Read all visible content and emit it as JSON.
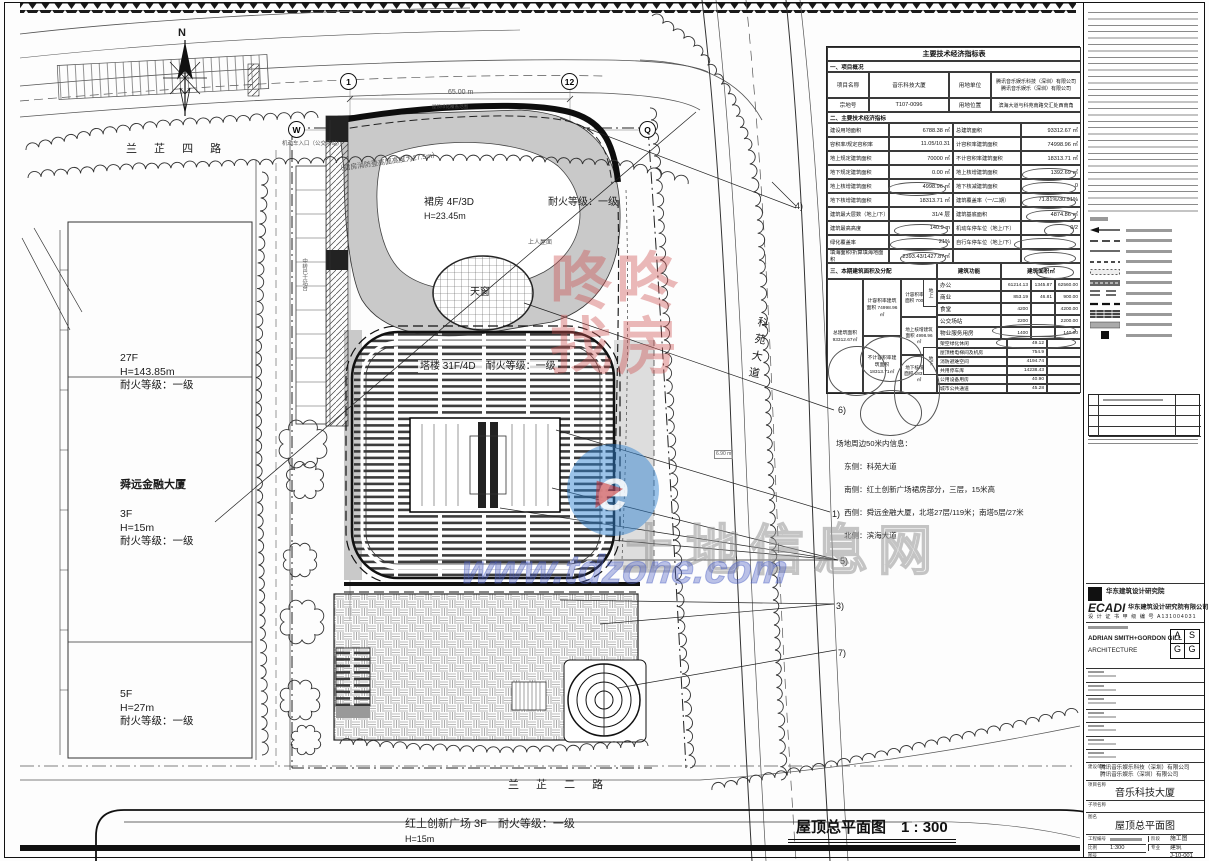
{
  "main_title": {
    "text": "屋顶总平面图",
    "scale": "1 : 300"
  },
  "plan_labels": {
    "north": "N",
    "road_top": "兰 芷 四 路",
    "road_right": "科苑大道",
    "road_bottom": "兰 芷 二 路",
    "b27_1": "27F",
    "b27_2": "H=143.85m",
    "b27_3": "耐火等级：一级",
    "sy_name": "舜远金融大厦",
    "sy_1": "3F",
    "sy_2": "H=15m",
    "sy_3": "耐火等级：一级",
    "b5_1": "5F",
    "b5_2": "H=27m",
    "b5_3": "耐火等级：一级",
    "ht_name": "红土创新广场 3F　耐火等级：一级",
    "ht_h": "H=15m",
    "podium": "裙房 4F/3D",
    "podium_fire": "耐火等级：一级",
    "podium_h": "H=23.45m",
    "tower": "塔楼 31F/4D　耐火等级：一级",
    "skylight": "天窗",
    "roof_access": "上人屋面",
    "entrance": "机动车入口（公交场站）",
    "green_range": "屋顶绿化覆盖范围",
    "fire_height": "（裙房消防登高面高度为27.5m）",
    "bus": "中转巴士站台",
    "dim65": "65.00 m",
    "elev": "6.90 m"
  },
  "bubbles": [
    "1",
    "12",
    "W",
    "Q"
  ],
  "callouts": [
    "1)",
    "2)",
    "3)",
    "4)",
    "5)",
    "6)",
    "7)"
  ],
  "site_note": {
    "title": "场地周边50米内信息：",
    "lines": [
      "东侧：科苑大道",
      "南侧：红土创新广场裙房部分，三层，15米高",
      "西侧：舜远金融大厦，北塔27层/119米；南塔5层/27米",
      "北侧：滨海大道"
    ]
  },
  "econ": {
    "title": "主要技术经济指标表",
    "section1": "一、项目概况",
    "row_name": [
      "项目名称",
      "音乐科技大厦",
      "用地单位"
    ],
    "client_lines": [
      "腾讯音乐娱乐科技（深圳）有限公司",
      "腾讯音乐娱乐（深圳）有限公司"
    ],
    "row_lot": [
      "宗地号",
      "T107-0096",
      "用地位置",
      "滨海大道与科苑南路交汇处西南角"
    ],
    "section2": "二、主要技术经济指标",
    "rows2": [
      [
        "建设用地面积",
        "6788.38 ㎡",
        "总建筑面积",
        "93312.67 ㎡"
      ],
      [
        "容积率/规定容积率",
        "11.05/10.31",
        "计容积率建筑面积",
        "74998.96 ㎡"
      ],
      [
        "地上规定建筑面积",
        "70000 ㎡",
        "不计容积率建筑面积",
        "18313.71 ㎡"
      ],
      [
        "地下规定建筑面积",
        "0.00 ㎡",
        "地上核增建筑面积",
        "1392.69 ㎡"
      ],
      [
        "地上核增建筑面积",
        "4998.96 ㎡",
        "地下核减建筑面积",
        "0"
      ],
      [
        "地下核增建筑面积",
        "18313.71 ㎡",
        "建筑覆盖率（一/二期）",
        "71.81%/30.91%"
      ],
      [
        "建筑最大层数（地上/下）",
        "31/4 层",
        "建筑基底面积",
        "4874.86 ㎡"
      ],
      [
        "建筑最高高度",
        "140.9 m",
        "机动车停车位（地上/下）",
        "0/2"
      ],
      [
        "绿化覆盖率",
        "21%",
        "自行车停车位（地上/下）",
        ""
      ],
      [
        "填海面积/折算填海地面积",
        "2393.43/1427.87㎡",
        "",
        ""
      ]
    ],
    "section3": "三、本期建筑面积及分配",
    "func_header": [
      "建筑功能",
      "建筑面积㎡"
    ],
    "func_rows": [
      [
        "办公",
        "61214.13",
        "1345.87",
        "62560.00"
      ],
      [
        "商业",
        "853.19",
        "46.81",
        "900.00"
      ],
      [
        "食堂",
        "4200",
        "",
        "4200.00"
      ],
      [
        "公交场站",
        "2200",
        "",
        "2200.00"
      ],
      [
        "物业服务用房",
        "1400",
        "",
        "140.00"
      ]
    ],
    "single_rows": [
      [
        "架空绿化休闲",
        "49.12"
      ],
      [
        "屋顶楼电梯间及机房",
        "754.9"
      ],
      [
        "消防避难空间",
        "4194.74"
      ],
      [
        "共用停车库",
        "14238.43"
      ],
      [
        "公用设备用房",
        "40.90"
      ],
      [
        "城市公共通道",
        "45.28"
      ]
    ],
    "agg": [
      [
        "总建筑面积",
        "93312.67㎡"
      ],
      [
        "计容积率建筑面积",
        "74998.96㎡"
      ],
      [
        "不计容积率建筑面积",
        "18313.71㎡"
      ],
      [
        "计容积率建筑面积",
        "70000㎡"
      ],
      [
        "地上核增建筑面积",
        "4998.96㎡"
      ],
      [
        "地下核增建筑面积",
        "18313.71㎡"
      ]
    ],
    "tags": [
      "地上",
      "地下"
    ]
  },
  "legend": {
    "heading": "图例",
    "symbols": [
      "arrow-line",
      "long-dash",
      "solid-line",
      "short-dash",
      "dotted-rect",
      "hatch-bar",
      "double-dash",
      "bold-dash",
      "crosshatch-bar",
      "gray-bar",
      "black-square"
    ]
  },
  "titleblock": {
    "firm_logo_text": "华东建筑设计研究院",
    "firm_abbr": "ECADI",
    "firm_cn": "华东建筑设计研究院有限公司",
    "cert": "设 计 证 书 甲 级 编 号 A131004031",
    "partner_name": "ADRIAN SMITH+GORDON GILL",
    "partner_type": "ARCHITECTURE",
    "partner_logo": [
      "A",
      "S",
      "G",
      "G"
    ],
    "client_label": "建设单位",
    "client1": "腾讯音乐娱乐科技（深圳）有限公司",
    "client2": "腾讯音乐娱乐（深圳）有限公司",
    "project_label": "项目名称",
    "project": "音乐科技大厦",
    "subproject_label": "子项名称",
    "drawing_label": "图名",
    "drawing": "屋顶总平面图",
    "job_no_label": "工程编号",
    "stage_label": "阶段",
    "stage": "施工图",
    "scale_label": "比例",
    "scale": "1:300",
    "discipline_label": "专业",
    "discipline": "建筑",
    "dwg_label": "图号",
    "dwg_no": "J-10-001"
  },
  "watermark": {
    "row1": "咚咚",
    "row2": "找房",
    "url": "www.tdzone.com",
    "site_name": "土地信息网"
  }
}
